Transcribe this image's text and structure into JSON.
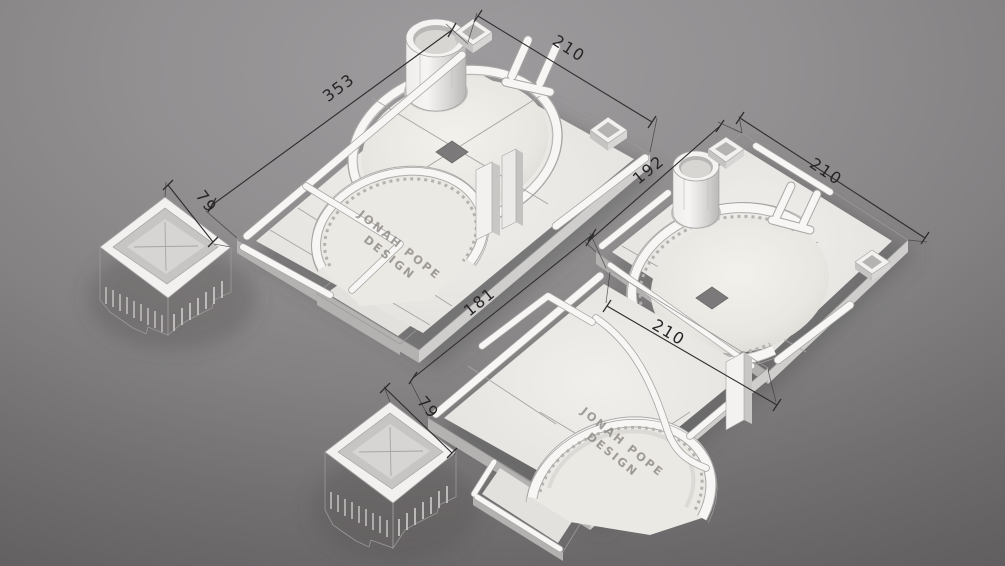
{
  "annotations": {
    "model_a": {
      "left_dim": "353",
      "right_dim": "210"
    },
    "model_b": {
      "left_dim": "192",
      "right_dim": "210"
    },
    "model_c": {
      "left_dim": "181",
      "right_dim": "210"
    },
    "tower_left": {
      "dim": "79"
    },
    "tower_right": {
      "dim": "79"
    }
  },
  "branding": {
    "line1": "JONAH POPE",
    "line2": "DESIGN"
  },
  "colors": {
    "background_top": "#9d9b9d",
    "background_bottom": "#5f5d5e",
    "model_white": "#f2f1ef",
    "model_floor": "#e5e3e0",
    "plate_side_dark": "#b4b2b1",
    "plate_side_light": "#d0cecd",
    "hole_dark": "#7b7979",
    "dimension_ink": "#262425",
    "engraved_text": "#8b8683"
  }
}
